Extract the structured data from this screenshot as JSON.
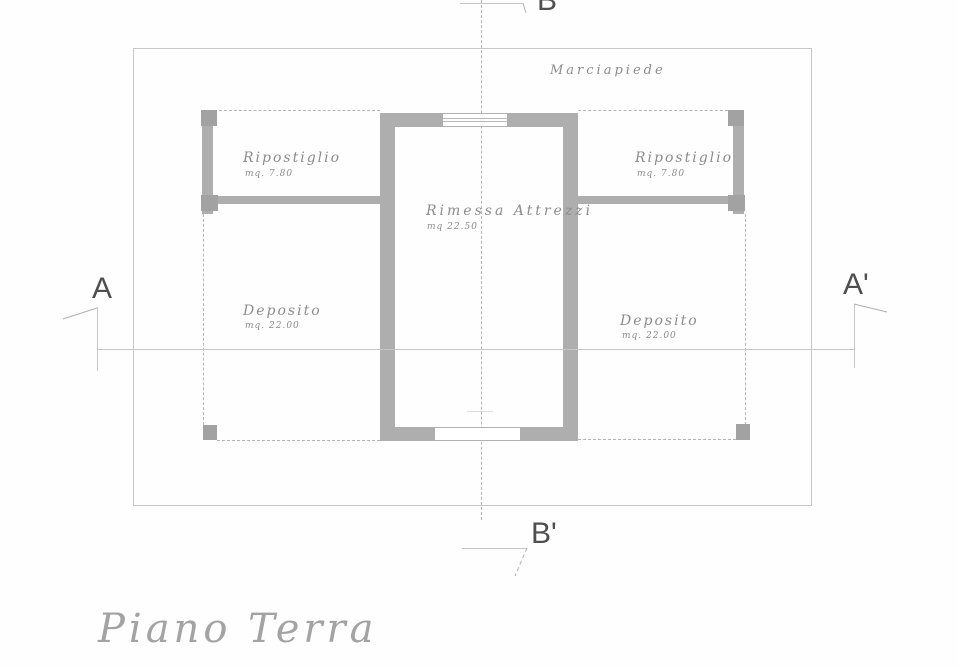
{
  "drawing": {
    "title": "Piano Terra",
    "area_label": "Marciapiede",
    "rooms": {
      "ripostiglio_left": {
        "name": "Ripostiglio",
        "area": "mq. 7.80"
      },
      "ripostiglio_right": {
        "name": "Ripostiglio",
        "area": "mq. 7.80"
      },
      "rimessa": {
        "name": "Rimessa Attrezzi",
        "area": "mq 22.50"
      },
      "deposito_left": {
        "name": "Deposito",
        "area": "mq. 22.00"
      },
      "deposito_right": {
        "name": "Deposito",
        "area": "mq. 22.00"
      }
    },
    "sections": {
      "a": "A",
      "a_prime": "A'",
      "b": "B",
      "b_prime": "B'"
    },
    "colors": {
      "wall": "#aeaeae",
      "pillar": "#a2a2a2",
      "line": "#c6c6c6",
      "dashed": "#b5b5b5",
      "label": "#8c8c8c",
      "marker": "#4f4f4f",
      "title": "#a3a3a3"
    }
  }
}
